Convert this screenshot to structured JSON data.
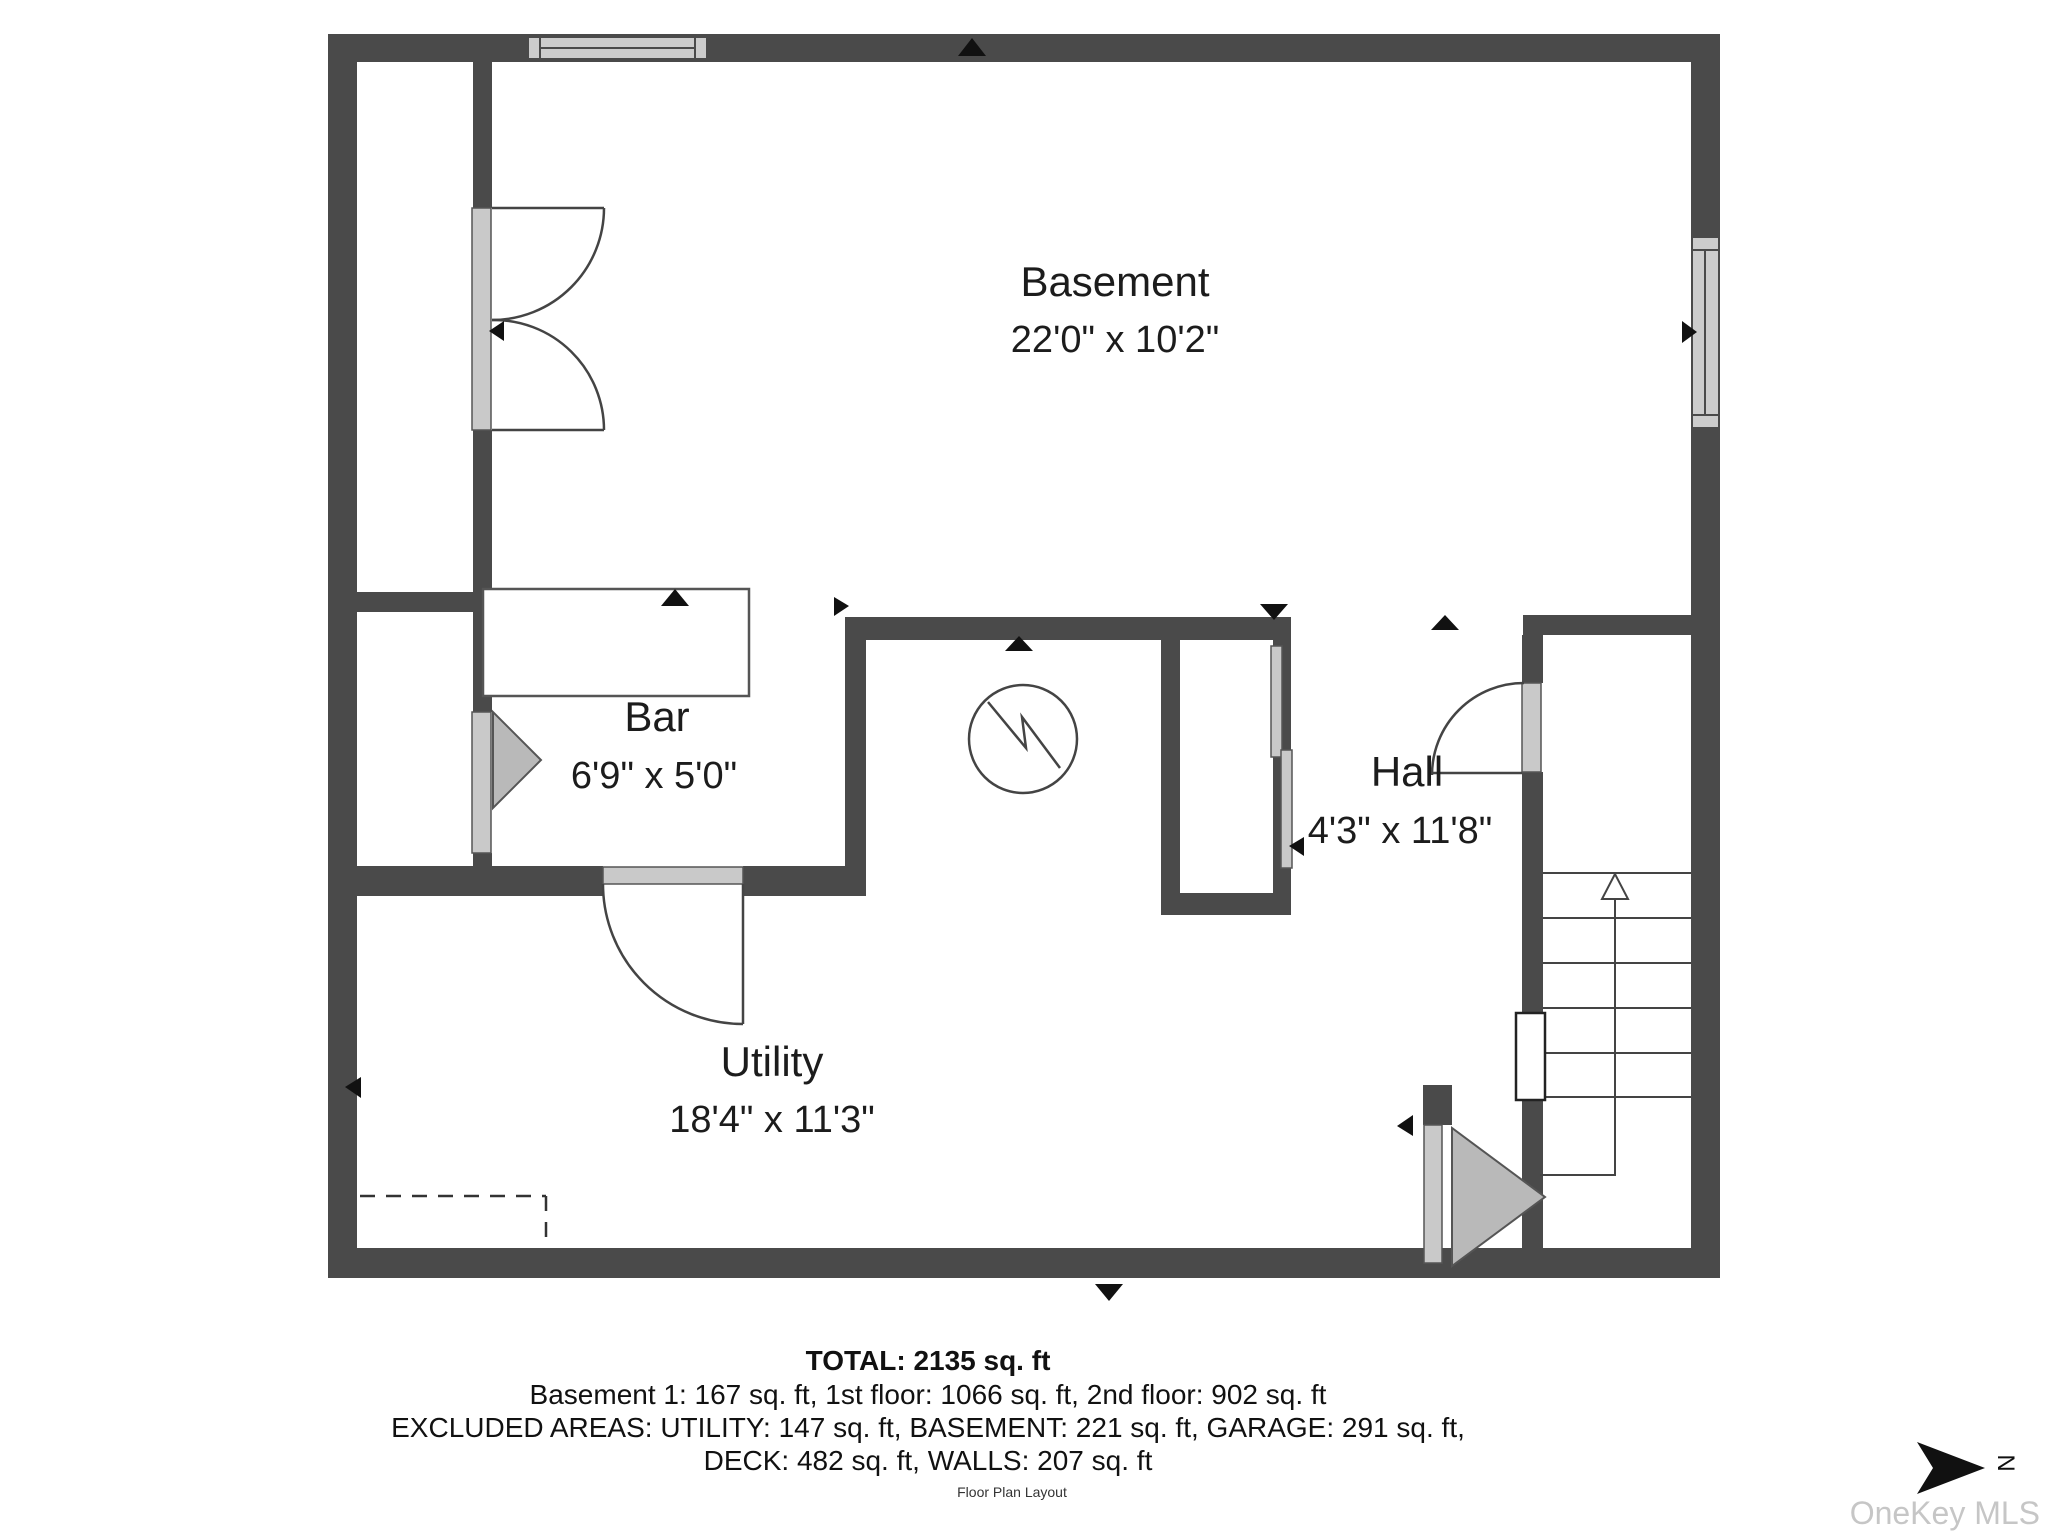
{
  "plan": {
    "rooms": [
      {
        "name": "Basement",
        "dims": "22'0\" x 10'2\""
      },
      {
        "name": "Bar",
        "dims": "6'9\" x 5'0\""
      },
      {
        "name": "Hall",
        "dims": "4'3\" x 11'8\""
      },
      {
        "name": "Utility",
        "dims": "18'4\" x 11'3\""
      }
    ],
    "compass_label": "N"
  },
  "footer": {
    "total": "TOTAL: 2135 sq. ft",
    "line2": "Basement 1: 167 sq. ft, 1st floor: 1066 sq. ft, 2nd floor: 902 sq. ft",
    "line3": "EXCLUDED AREAS: UTILITY: 147 sq. ft, BASEMENT: 221 sq. ft, GARAGE: 291 sq. ft,",
    "line4": "DECK: 482 sq. ft, WALLS: 207 sq. ft",
    "caption": "Floor Plan Layout"
  },
  "watermark": "OneKey MLS",
  "colors": {
    "wall": "#4a4a4a",
    "door_fill": "#c9c9c9",
    "triangle_fill": "#b9b9b9",
    "text": "#1c1c1c",
    "watermark": "#c6c6c6"
  }
}
